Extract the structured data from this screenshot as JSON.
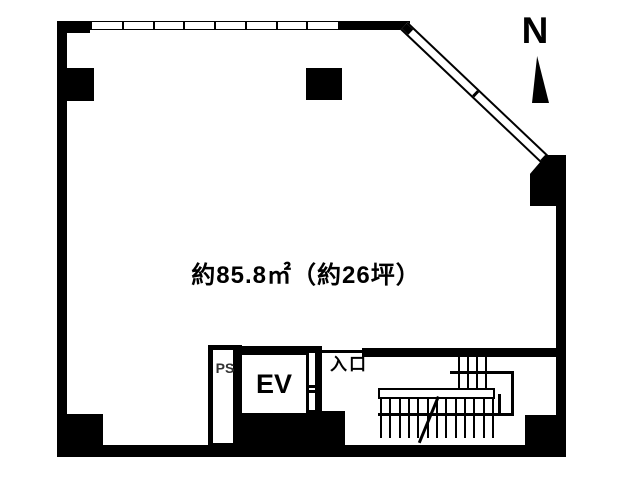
{
  "floorplan": {
    "area_label": "約85.8㎡（約26坪）",
    "labels": {
      "entrance": "入口",
      "elevator": "EV",
      "pipe_space": "PS",
      "compass_north": "N"
    },
    "colors": {
      "ink": "#000000",
      "background": "#ffffff",
      "pipe_space_text": "#333333"
    }
  }
}
